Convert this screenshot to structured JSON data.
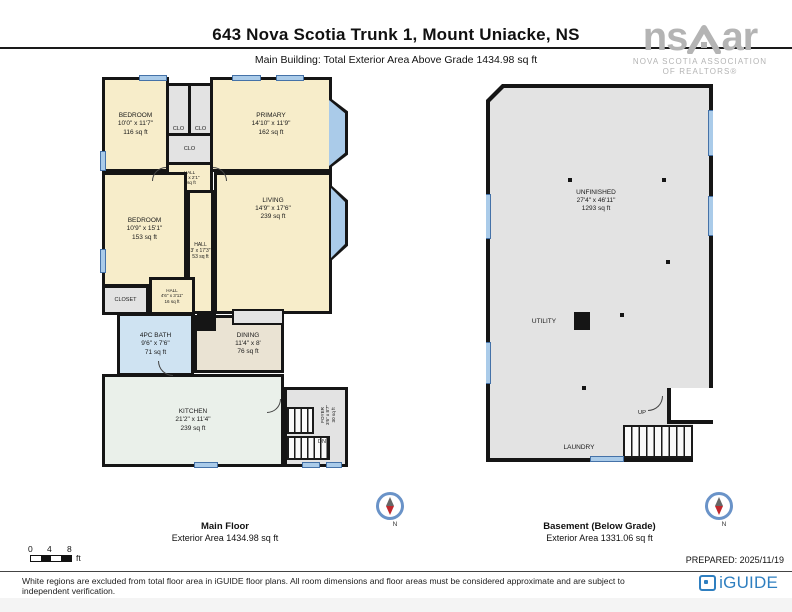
{
  "header": {
    "title": "643 Nova Scotia Trunk 1, Mount Uniacke, NS",
    "subtitle": "Main Building: Total Exterior Area Above Grade 1434.98 sq ft"
  },
  "nsar_logo": {
    "ns": "ns",
    "ar": "ar",
    "line1": "NOVA SCOTIA ASSOCIATION",
    "line2": "OF REALTORS®"
  },
  "main_floor": {
    "rooms": {
      "bedroom1": {
        "name": "BEDROOM",
        "dims": "10'0\" x 11'7\"",
        "area": "116 sq ft"
      },
      "primary": {
        "name": "PRIMARY",
        "dims": "14'10\" x 11'9\"",
        "area": "162 sq ft"
      },
      "clo": {
        "name": "CLO"
      },
      "hall_top": {
        "name": "HALL",
        "dims": "4'6\" x 2'1\"",
        "area": "9 sq ft"
      },
      "bedroom2": {
        "name": "BEDROOM",
        "dims": "10'9\" x 15'1\"",
        "area": "153 sq ft"
      },
      "hall_mid": {
        "name": "HALL",
        "dims": "3' x 17'3\"",
        "area": "53 sq ft"
      },
      "living": {
        "name": "LIVING",
        "dims": "14'9\" x 17'6\"",
        "area": "239 sq ft"
      },
      "closet": {
        "name": "CLOSET"
      },
      "hall_lower": {
        "name": "HALL",
        "dims": "4'6\" x 3'11\"",
        "area": "16 sq ft"
      },
      "bath": {
        "name": "4PC BATH",
        "dims": "9'6\" x 7'6\"",
        "area": "71 sq ft"
      },
      "dining": {
        "name": "DINING",
        "dims": "11'4\" x 8'",
        "area": "76 sq ft"
      },
      "kitchen": {
        "name": "KITCHEN",
        "dims": "21'2\" x 11'4\"",
        "area": "239 sq ft"
      },
      "foyer": {
        "name": "FOYER",
        "dims": "3'6\" x 8'7\"",
        "area": "30 sq ft"
      },
      "dn": "DN"
    },
    "caption_title": "Main Floor",
    "caption_area": "Exterior Area 1434.98 sq ft"
  },
  "basement": {
    "rooms": {
      "unfinished": {
        "name": "UNFINISHED",
        "dims": "27'4\" x 46'11\"",
        "area": "1293 sq ft"
      },
      "utility": {
        "name": "UTILITY"
      },
      "laundry": {
        "name": "LAUNDRY"
      },
      "up": "UP"
    },
    "caption_title": "Basement (Below Grade)",
    "caption_area": "Exterior Area 1331.06 sq ft"
  },
  "compass": {
    "north": "N"
  },
  "scale_bar": {
    "t0": "0",
    "t1": "4",
    "t2": "8",
    "unit": "ft"
  },
  "prepared": "PREPARED: 2025/11/19",
  "footer": {
    "disclaimer": "White regions are excluded from total floor area in iGUIDE floor plans. All room dimensions and floor areas must be considered approximate and are subject to independent verification.",
    "brand": "iGUIDE"
  },
  "colors": {
    "room_cream": "#f7edca",
    "room_bath_blue": "#cfe3f2",
    "room_dining_tan": "#eae3d3",
    "room_kitchen_green": "#eaf0ea",
    "room_gray": "#e3e3e3",
    "wall_black": "#151515",
    "window_blue": "#aacbe9",
    "brand_blue": "#2f7fc0",
    "logo_gray": "#b4b4b4",
    "compass_red": "#c0282d"
  }
}
